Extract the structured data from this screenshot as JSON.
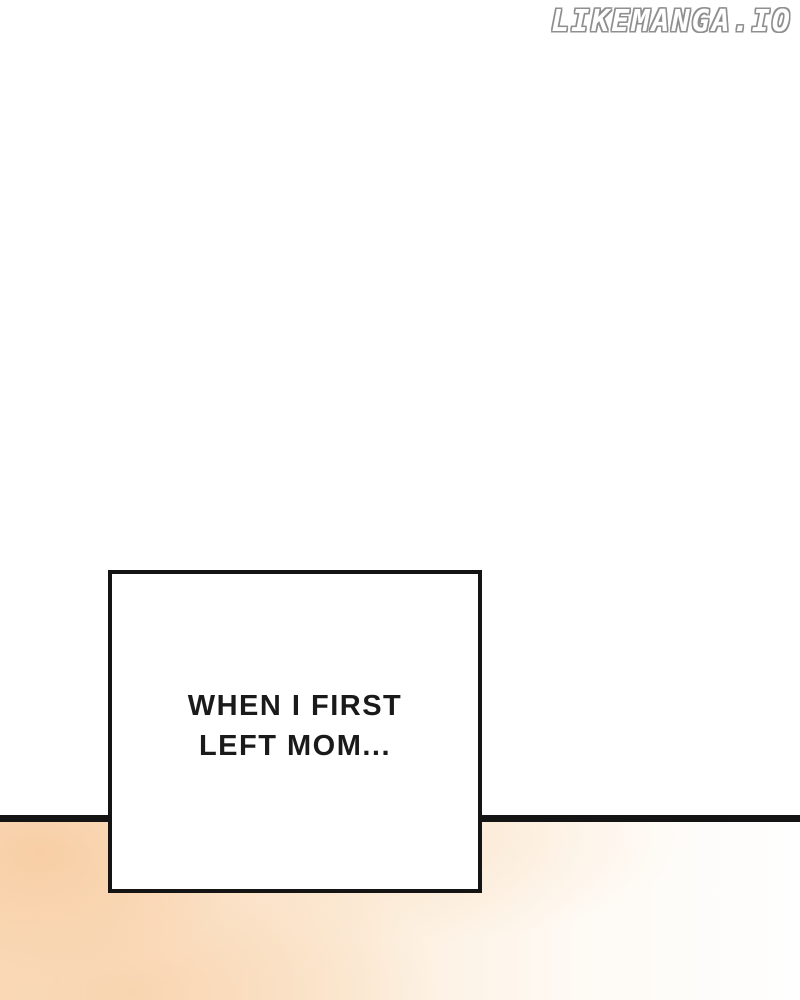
{
  "watermark": {
    "text": "LIKEMANGA.IO",
    "fill_color": "#ffffff",
    "outline_color": "#8f8f8f"
  },
  "divider": {
    "color": "#141414"
  },
  "speech_box": {
    "lines": [
      "WHEN I FIRST",
      "LEFT MOM..."
    ],
    "full_text": "WHEN I FIRST LEFT MOM...",
    "border_color": "#141414",
    "background_color": "#ffffff",
    "text_color": "#1a1a1a"
  },
  "bottom_panel": {
    "peach_color": "#f8cda4",
    "light_peach_color": "#fbdfc3",
    "fade_color": "#fefefe"
  }
}
